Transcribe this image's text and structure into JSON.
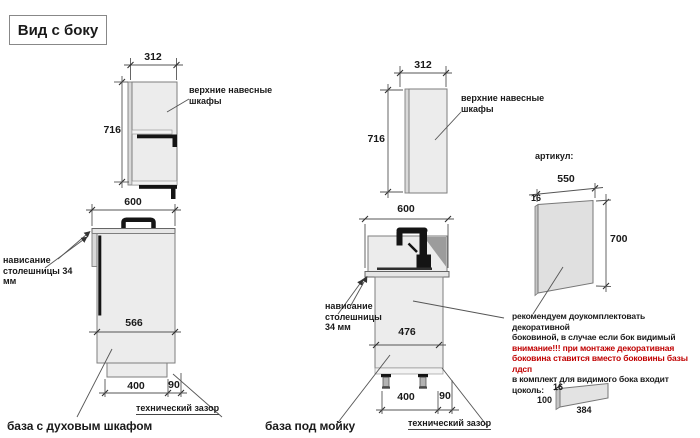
{
  "title": "Вид с боку",
  "left": {
    "upper_width": "312",
    "upper_height": "716",
    "upper_label": "верхние навесные\nшкафы",
    "base_width": "600",
    "overhang_label": "нависание\nстолешницы 34 мм",
    "base_depth": "566",
    "plinth_depth": "400",
    "back_gap": "90",
    "gap_label": "технический зазор",
    "caption": "база с духовым шкафом"
  },
  "middle": {
    "upper_width": "312",
    "upper_height": "716",
    "upper_label": "верхние навесные\nшкафы",
    "base_width": "600",
    "overhang_label": "нависание\nстолешницы\n34 мм",
    "base_depth": "476",
    "plinth_depth": "400",
    "back_gap": "90",
    "gap_label": "технический зазор",
    "caption": "база под мойку"
  },
  "right": {
    "article_label": "артикул:",
    "panel_width": "550",
    "panel_thickness": "16",
    "panel_height": "700",
    "note": {
      "line1": "рекомендуем доукомплектовать декоративной",
      "line2": "боковиной, в случае если бок видимый",
      "line3": "внимание!!! при монтаже декоративная",
      "line4": "боковина ставится вместо боковины базы лдсп",
      "line5": "в комплект для видимого бока входит цоколь:"
    },
    "plinth_thickness": "16",
    "plinth_height": "100",
    "plinth_length": "384"
  },
  "colors": {
    "attention": "#c00000",
    "text": "#1a1a1a"
  }
}
